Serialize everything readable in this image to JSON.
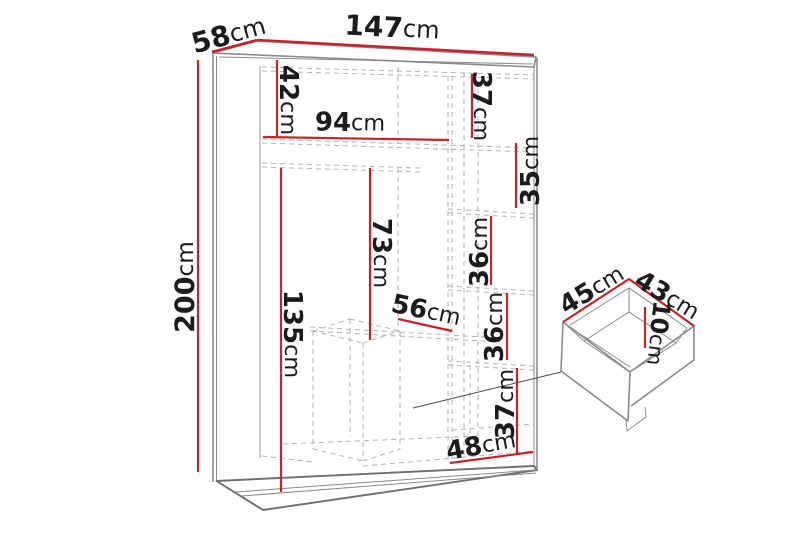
{
  "diagram": {
    "unit": "cm",
    "colors": {
      "dimension_line": "#c82127",
      "outline": "#8a8a8a",
      "outline_dark": "#6e6e6e",
      "dashed": "#b2b2b2",
      "label": "#1b1b1b",
      "leader": "#4a4a4a",
      "background": "#ffffff"
    },
    "wardrobe": {
      "total_width": {
        "value": "147",
        "unit": "cm"
      },
      "total_depth": {
        "value": "58",
        "unit": "cm"
      },
      "total_height": {
        "value": "200",
        "unit": "cm"
      },
      "top_shelf_height": {
        "value": "42",
        "unit": "cm"
      },
      "top_shelf_width": {
        "value": "94",
        "unit": "cm"
      },
      "right_top_compartment_height": {
        "value": "37",
        "unit": "cm"
      },
      "right_shelf_1_height": {
        "value": "35",
        "unit": "cm"
      },
      "right_shelf_2_height": {
        "value": "36",
        "unit": "cm"
      },
      "right_shelf_3_height": {
        "value": "36",
        "unit": "cm"
      },
      "right_bottom_compartment_height": {
        "value": "37",
        "unit": "cm"
      },
      "bottom_compartment_width": {
        "value": "48",
        "unit": "cm"
      },
      "hanging_space_height": {
        "value": "135",
        "unit": "cm"
      },
      "middle_space_height": {
        "value": "73",
        "unit": "cm"
      },
      "shelf_depth": {
        "value": "56",
        "unit": "cm"
      }
    },
    "drawer": {
      "width": {
        "value": "45",
        "unit": "cm"
      },
      "depth": {
        "value": "43",
        "unit": "cm"
      },
      "height": {
        "value": "10",
        "unit": "cm"
      }
    }
  }
}
